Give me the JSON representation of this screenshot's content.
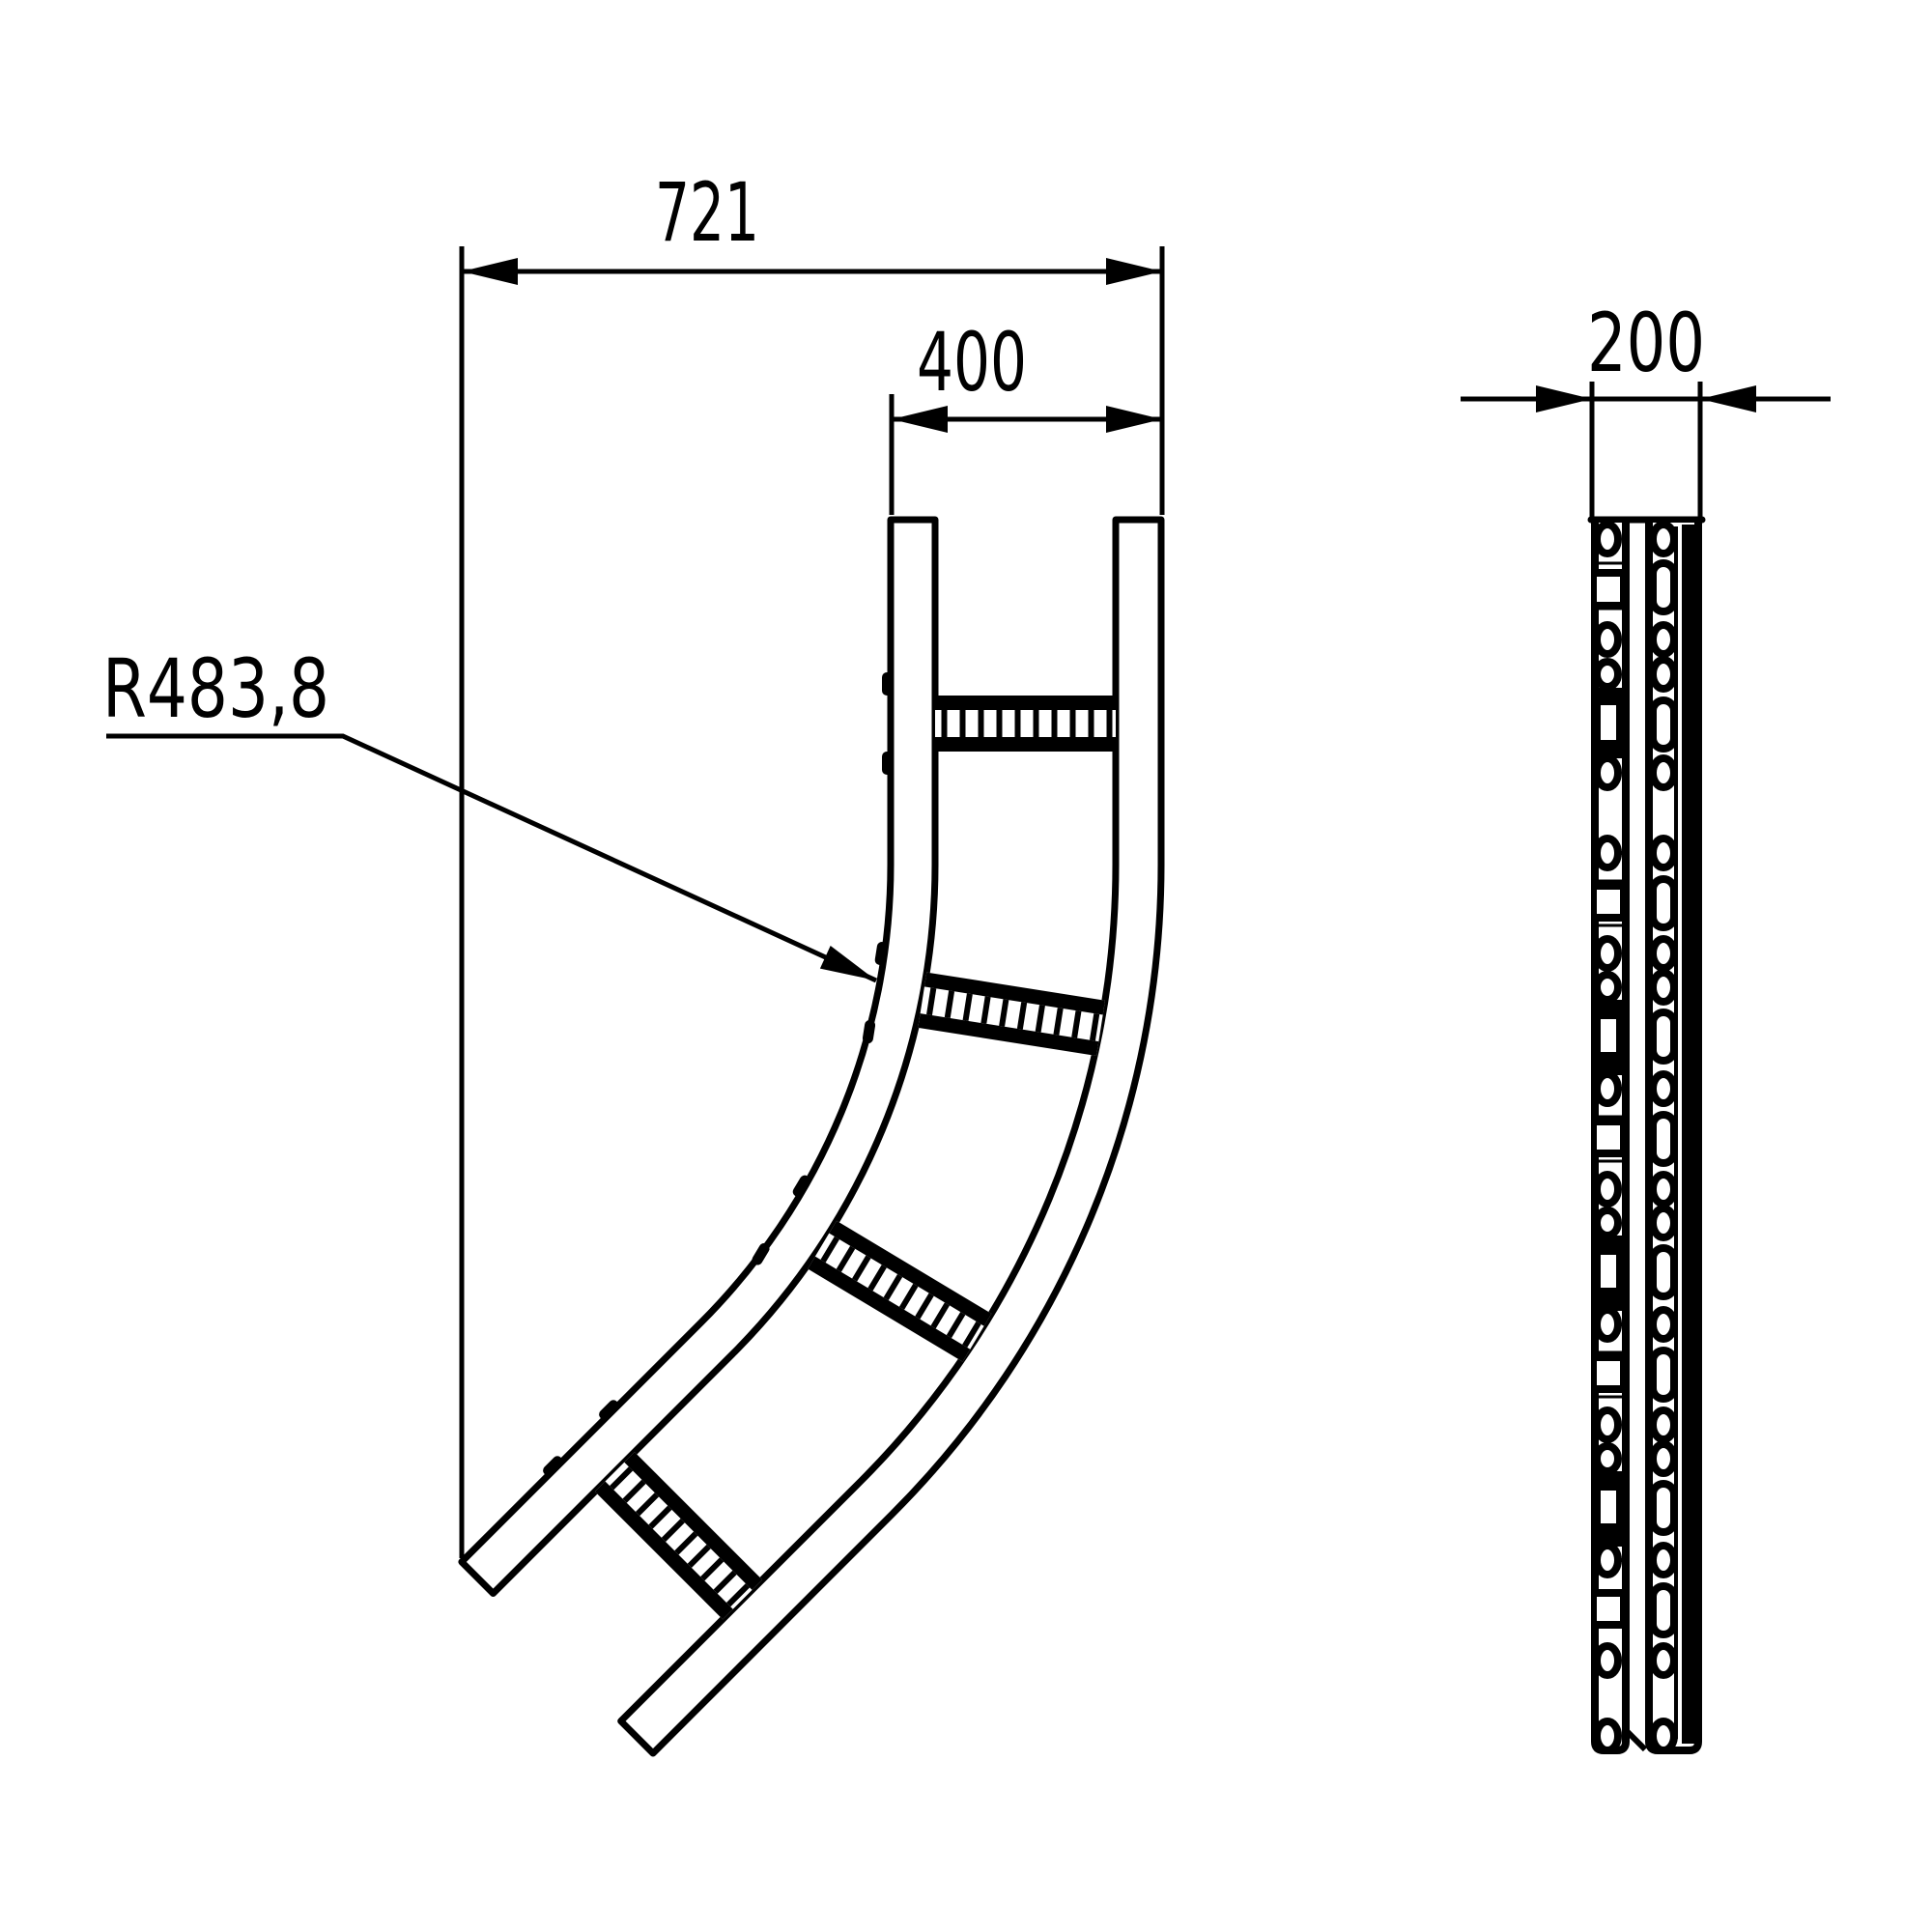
{
  "colors": {
    "ink": "#000000",
    "paper": "#ffffff"
  },
  "front_view": {
    "dim_overall_width": "721",
    "dim_top_width": "400",
    "dim_bend_radius": "R483,8"
  },
  "side_view": {
    "dim_depth": "200"
  }
}
